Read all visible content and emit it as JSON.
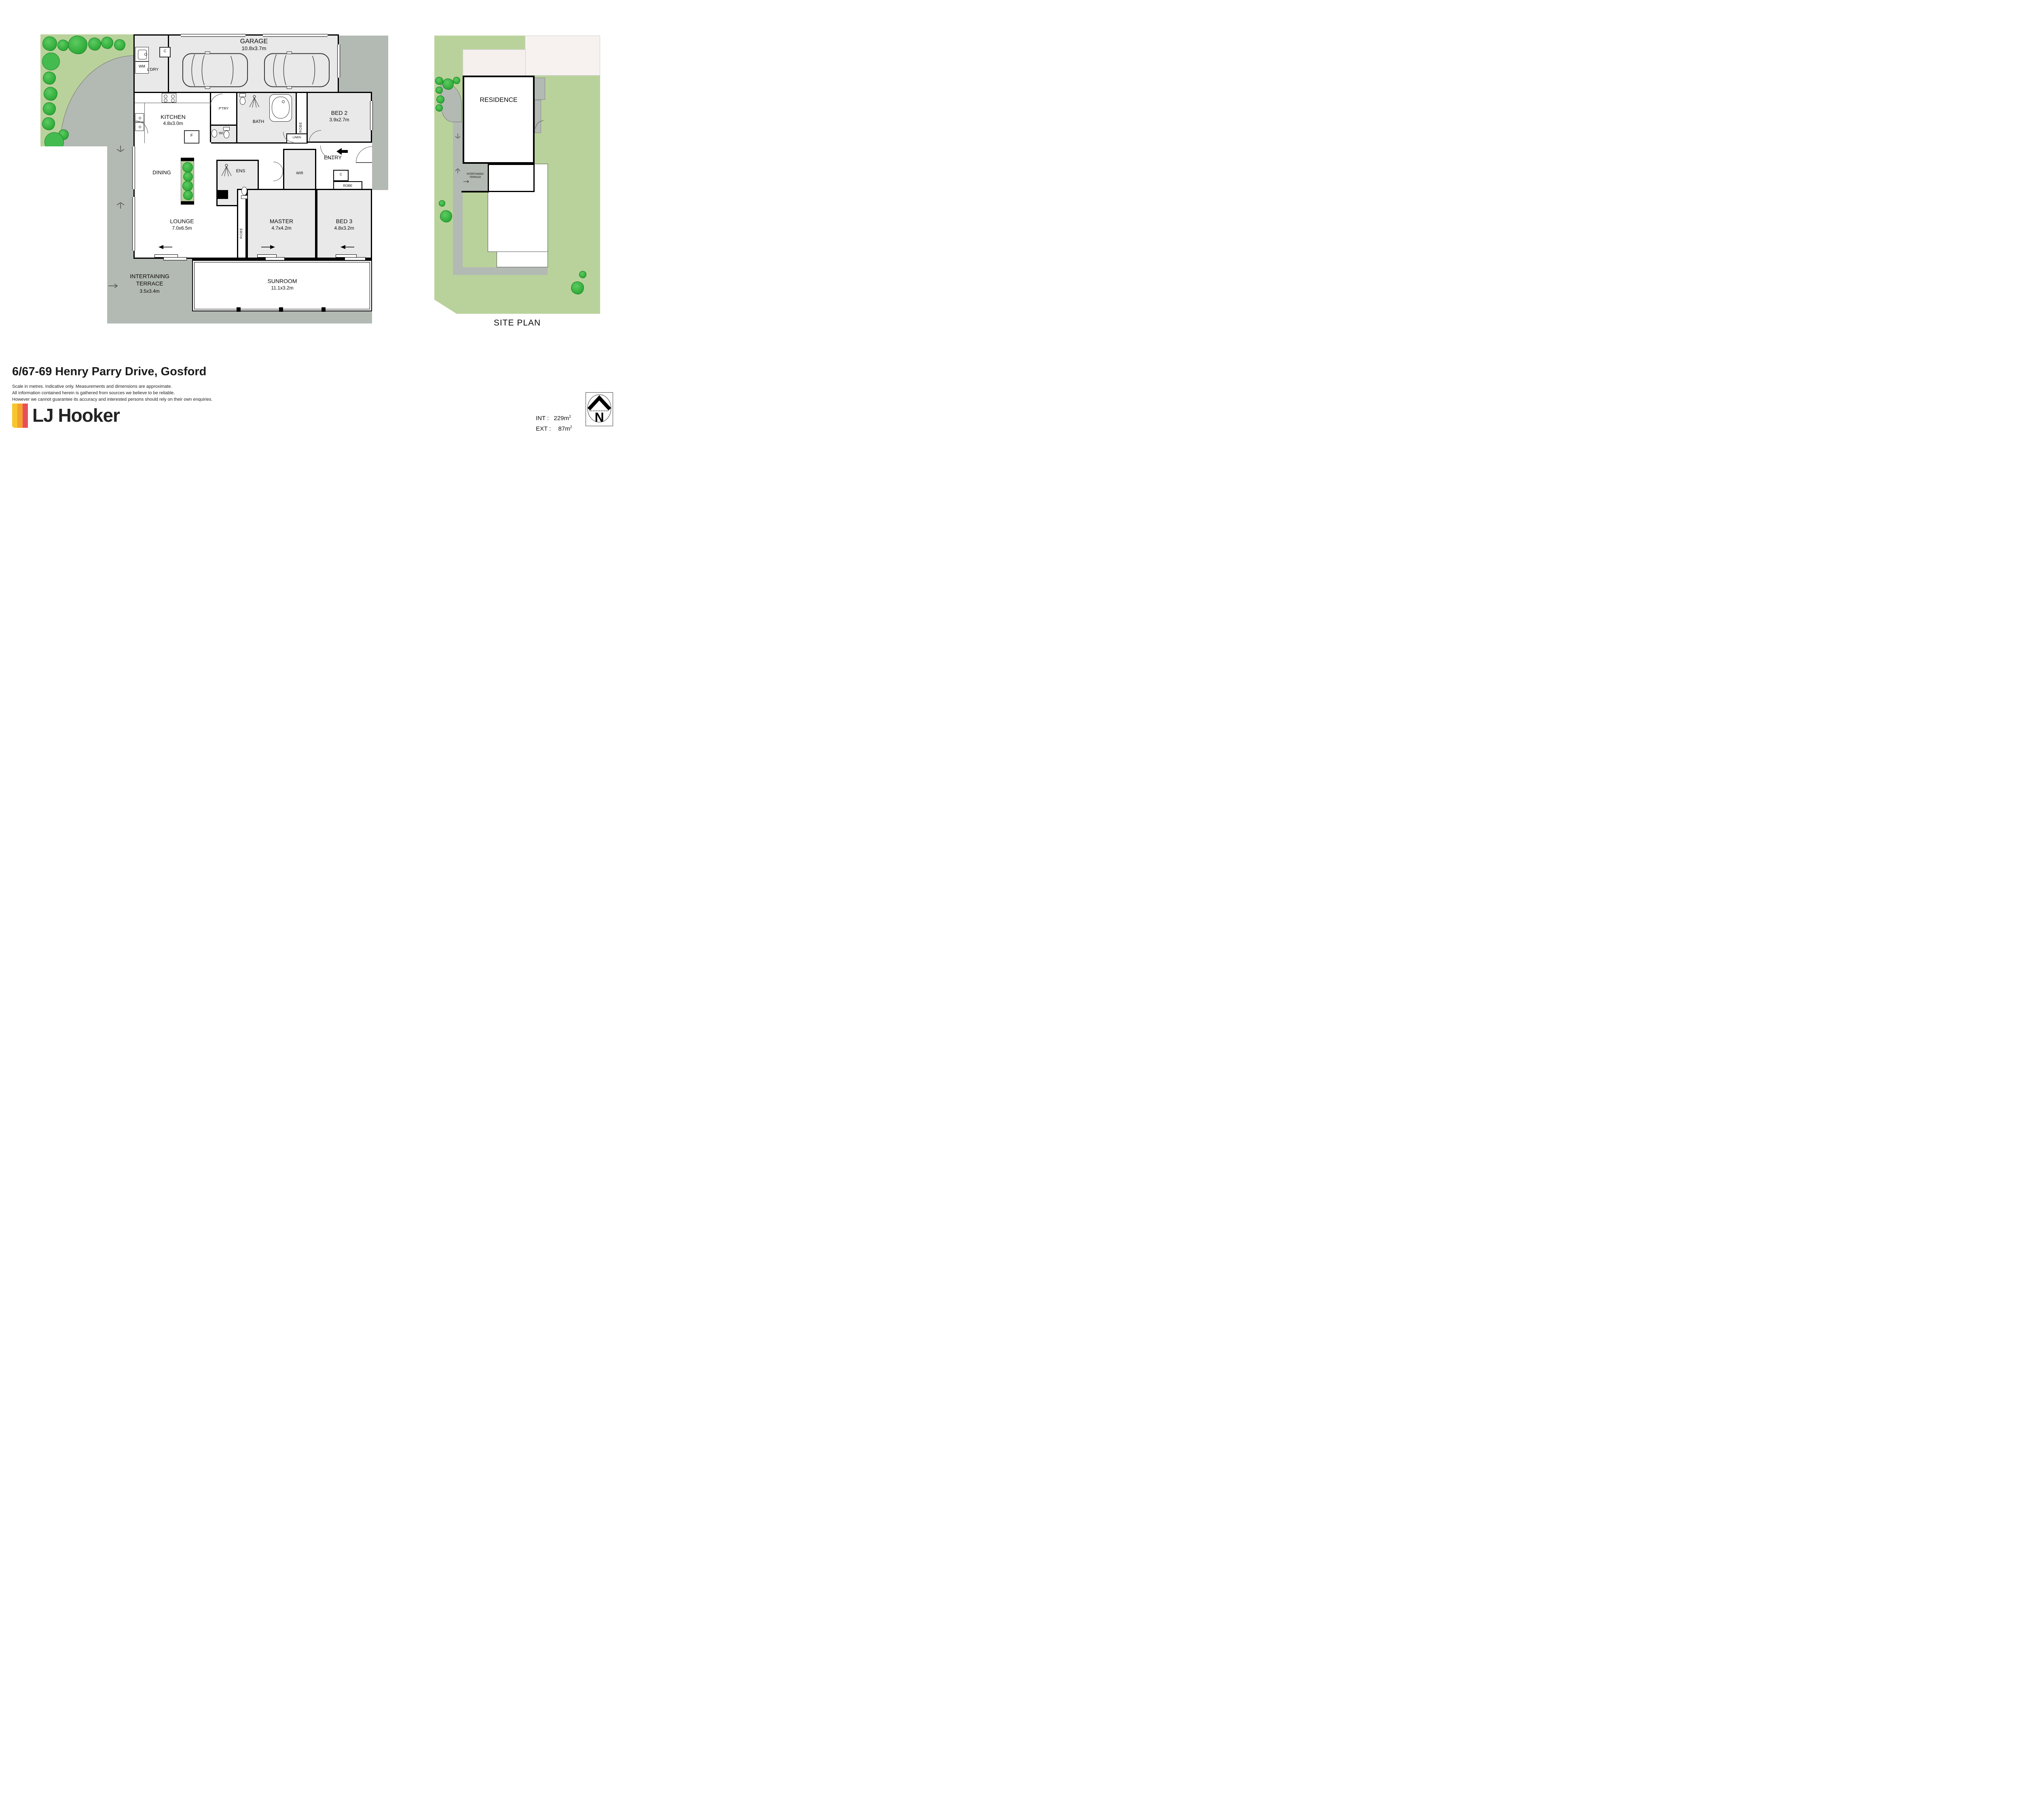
{
  "floorplan": {
    "garage": {
      "name": "GARAGE",
      "dims": "10.8x3.7m"
    },
    "ldry": "L'DRY",
    "wm": "WM",
    "c_ldry": "C",
    "kitchen": {
      "name": "KITCHEN",
      "dims": "4.8x3.0m"
    },
    "fridge": "F",
    "ptry": "P'TRY",
    "wc": "WC",
    "bath": "BATH",
    "robe_bed2": "ROBE",
    "bed2": {
      "name": "BED 2",
      "dims": "3.9x2.7m"
    },
    "linen": "LINEN",
    "entry": "ENTRY",
    "c_hall": "C",
    "robe_bed3": "ROBE",
    "dining": "DINING",
    "ens": "ENS",
    "wir": "WIR",
    "lounge": {
      "name": "LOUNGE",
      "dims": "7.0x6.5m"
    },
    "robe_master": "ROBE",
    "master": {
      "name": "MASTER",
      "dims": "4.7x4.2m"
    },
    "bed3": {
      "name": "BED 3",
      "dims": "4.8x3.2m"
    },
    "terrace": {
      "line1": "INTERTAINING",
      "line2": "TERRACE",
      "dims": "3.5x3.4m"
    },
    "sunroom": {
      "name": "SUNROOM",
      "dims": "11.1x3.2m"
    }
  },
  "siteplan": {
    "residence": "RESIDENCE",
    "terrace_line1": "INTERTAINING",
    "terrace_line2": "TERRACE",
    "title": "SITE PLAN"
  },
  "footer": {
    "address": "6/67-69 Henry Parry Drive, Gosford",
    "disclaimer": [
      "Scale in metres. Indicative only. Measurements and dimensions are approximate.",
      "All information contained herein is gathered from sources we believe to be reliable.",
      "However we cannot guarantee its accuracy and interested persons should rely on their own enquiries."
    ],
    "brand": "LJ Hooker",
    "areas": {
      "int_label": "INT :",
      "int_value": "229",
      "ext_label": "EXT :",
      "ext_value": "87",
      "unit": "m",
      "sup": "2"
    },
    "north": "N"
  },
  "colors": {
    "lawn": "#b9d29b",
    "shrub_green": "#35b33f",
    "path_gray": "#b3b9b3",
    "room_gray": "#e9e9e9",
    "wall": "#000000",
    "brand_yellow": "#f7c62c",
    "brand_orange": "#f4a12e",
    "brand_red": "#e84f5c",
    "neighbour_pink": "#f5efed"
  }
}
